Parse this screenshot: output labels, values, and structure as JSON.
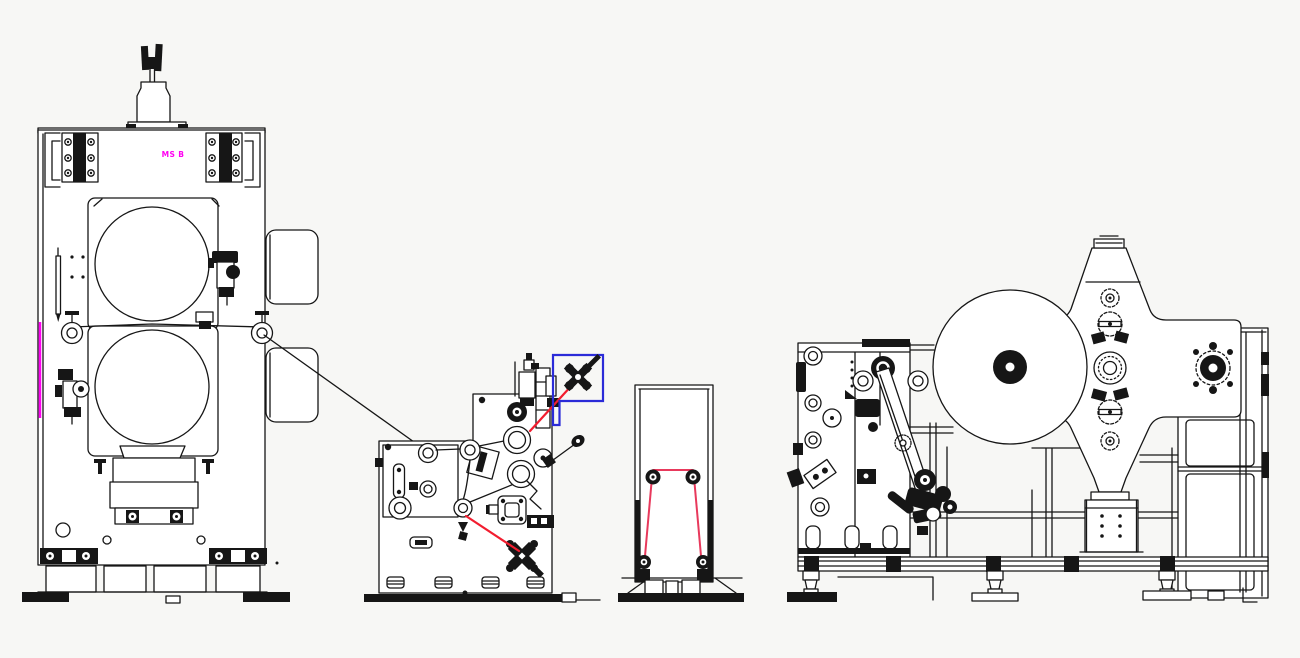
{
  "canvas": {
    "width": 1300,
    "height": 658
  },
  "colors": {
    "bg": "#f7f7f5",
    "paper": "#ffffff",
    "ink": "#161616",
    "red": "#f21d2f",
    "rose": "#e8395c",
    "blue": "#2b2bd8",
    "magenta": "#ff00f2"
  },
  "labels": {
    "plate_label": "MS B"
  }
}
